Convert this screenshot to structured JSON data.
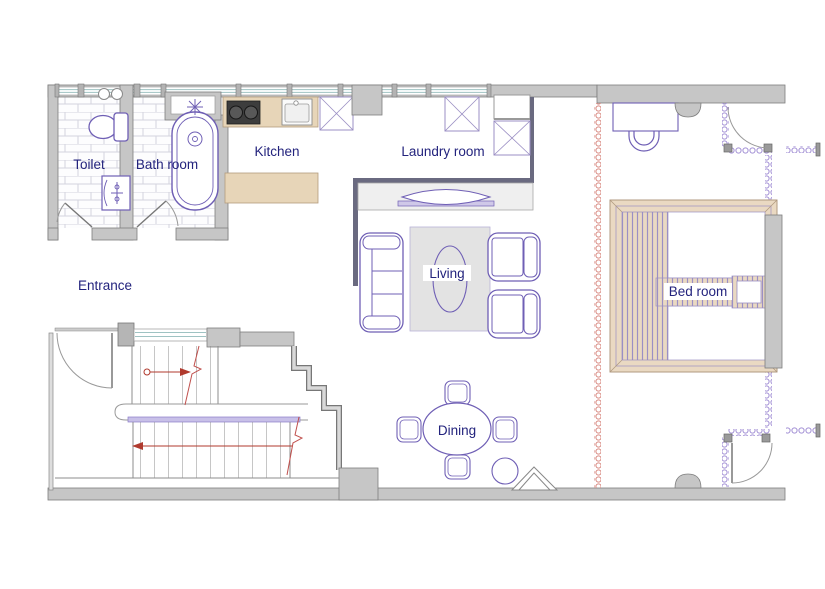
{
  "canvas": {
    "width": 825,
    "height": 589,
    "type": "architectural-floor-plan"
  },
  "rooms": {
    "toilet": {
      "label": "Toilet"
    },
    "bathroom": {
      "label": "Bath room"
    },
    "kitchen": {
      "label": "Kitchen"
    },
    "laundry": {
      "label": "Laundry room"
    },
    "entrance": {
      "label": "Entrance"
    },
    "living": {
      "label": "Living"
    },
    "dining": {
      "label": "Dining"
    },
    "bedroom": {
      "label": "Bed room"
    }
  },
  "colors": {
    "wall_fill": "#c6c6c6",
    "wall_stroke": "#7e7e7e",
    "interior_dark_wall": "#6a6a80",
    "counter_tan": "#e7d5b8",
    "furniture_outline": "#6f5fb5",
    "label_text": "#23237d",
    "stair_arrow_red": "#b03a2e",
    "break_line_red": "#c0504d",
    "coil_partition_red": "#d98c84",
    "coil_partition_purple": "#a593d6",
    "glass_teal": "#9fc3c3",
    "rug_gray": "#e3e3e3",
    "tile_line": "#d4d4de",
    "stove_black": "#3d3d3d"
  },
  "fixtures": [
    "toilet-wc",
    "wash-basin",
    "bathtub",
    "bath-window",
    "stove",
    "kitchen-sink",
    "kitchen-island",
    "refrigerator",
    "washer",
    "dryer",
    "tv",
    "tv-console",
    "sofa",
    "armchair",
    "coffee-table",
    "rug",
    "dining-table",
    "dining-chair",
    "stool",
    "pet-door",
    "bed",
    "bedside-table",
    "desk",
    "desk-chair",
    "stairs-upper-flight",
    "stairs-lower-flight",
    "stair-landing",
    "entrance-door",
    "toilet-door",
    "bathroom-door",
    "closet-door-top",
    "closet-door-bottom"
  ]
}
